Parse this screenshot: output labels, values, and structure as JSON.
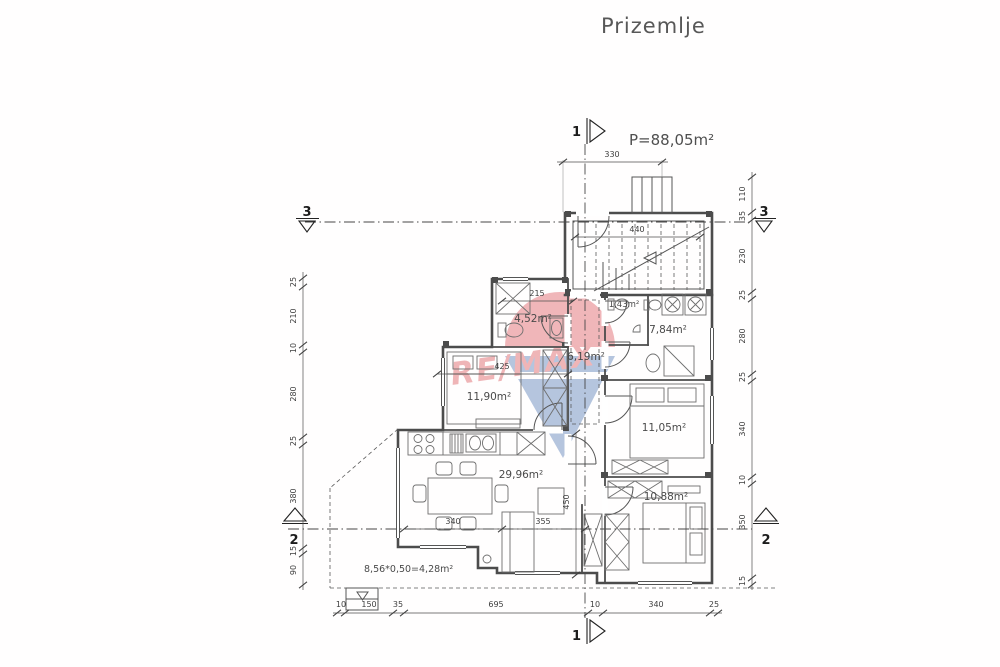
{
  "title": "Prizemlje",
  "area_label": "P=88,05m²",
  "watermark": {
    "brand": "RE/MAX"
  },
  "rooms": {
    "bath_top": "4,52m²",
    "wc": "1,43m²",
    "bath_right": "7,84m²",
    "hall": "6,19m²",
    "bedroom_left": "11,90m²",
    "bedroom_right": "11,05m²",
    "living": "29,96m²",
    "bedroom_bottom": "10,88m²",
    "terrace_formula": "8,56*0,50=4,28m²"
  },
  "dims": {
    "top_width": "330",
    "stair_width": "440",
    "bath_width": "215",
    "bedroom_left_width": "425",
    "dining_width": "340",
    "sofa_width": "355",
    "living_depth": "450",
    "left_chain": [
      "25",
      "210",
      "10",
      "280",
      "25",
      "380",
      "15",
      "90"
    ],
    "right_chain": [
      "110",
      "35",
      "230",
      "25",
      "280",
      "25",
      "340",
      "10",
      "350",
      "15"
    ],
    "bottom_chain": [
      "10",
      "150",
      "35",
      "695",
      "10",
      "340",
      "25"
    ]
  },
  "sections": {
    "s1": "1",
    "s2": "2",
    "s3": "3"
  }
}
